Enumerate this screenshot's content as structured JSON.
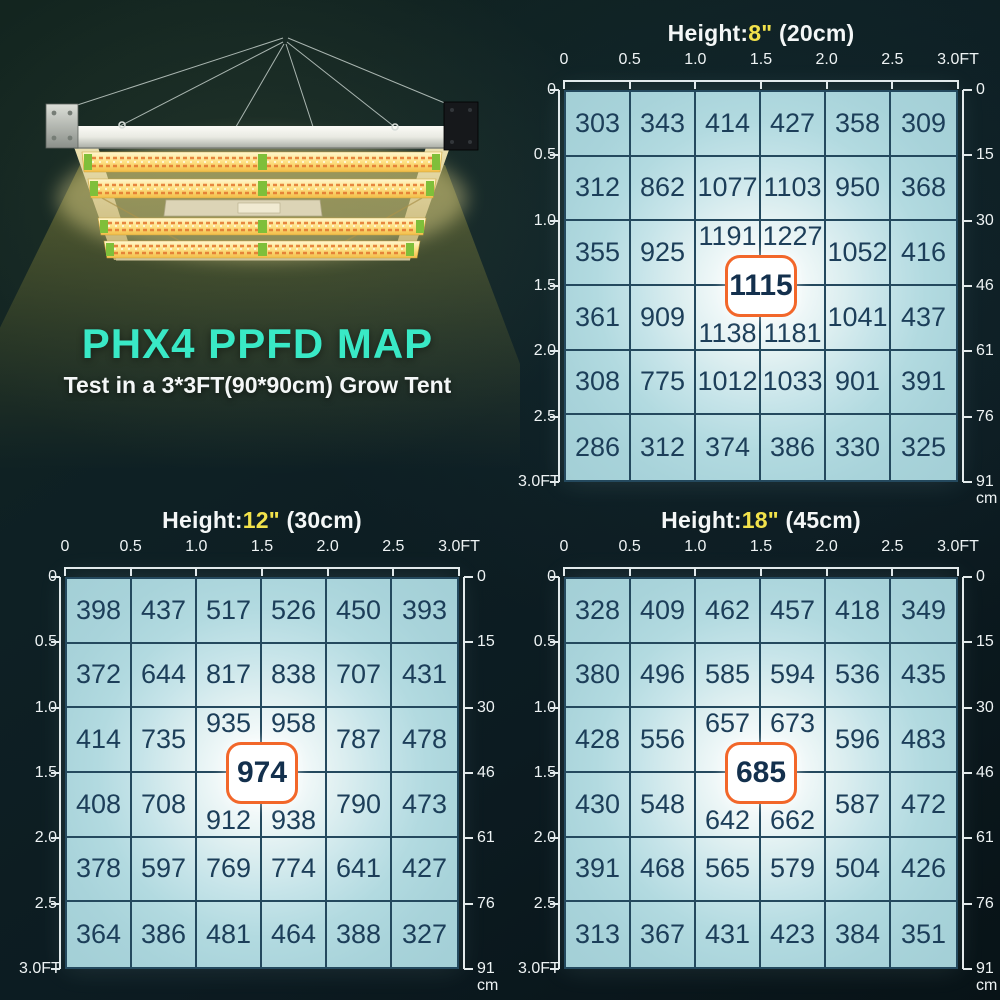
{
  "hero": {
    "title": "PHX4 PPFD MAP",
    "subtitle": "Test in a 3*3FT(90*90cm) Grow Tent"
  },
  "colors": {
    "accent_cyan": "#39e9c6",
    "height_yellow": "#f2e24b",
    "badge_orange": "#f2672a",
    "grid_line": "#24495e",
    "value_ink": "#1c3e59",
    "cell_bg": "#a8d3da",
    "axis_ink": "#eef3f4"
  },
  "chart_data": [
    {
      "type": "heatmap",
      "title": "Height:8\" (20cm)",
      "height_label": {
        "prefix": "Height:",
        "value": "8\"",
        "suffix": " (20cm)"
      },
      "x_ticks_ft": [
        "0",
        "0.5",
        "1.0",
        "1.5",
        "2.0",
        "2.5",
        "3.0FT"
      ],
      "y_ticks_ft": [
        "0",
        "0.5",
        "1.0",
        "1.5",
        "2.0",
        "2.5",
        "3.0FT"
      ],
      "y_ticks_cm": [
        "0",
        "15",
        "30",
        "46",
        "61",
        "76",
        "91"
      ],
      "cm_unit": "cm",
      "x_range_ft": [
        0,
        3.0
      ],
      "y_range_ft": [
        0,
        3.0
      ],
      "values": [
        [
          303,
          343,
          414,
          427,
          358,
          309
        ],
        [
          312,
          862,
          1077,
          1103,
          950,
          368
        ],
        [
          355,
          925,
          1191,
          1227,
          1052,
          416
        ],
        [
          361,
          909,
          1138,
          1181,
          1041,
          437
        ],
        [
          308,
          775,
          1012,
          1033,
          901,
          391
        ],
        [
          286,
          312,
          374,
          386,
          330,
          325
        ]
      ],
      "center_value": 1115
    },
    {
      "type": "heatmap",
      "title": "Height:12\" (30cm)",
      "height_label": {
        "prefix": "Height:",
        "value": "12\"",
        "suffix": " (30cm)"
      },
      "x_ticks_ft": [
        "0",
        "0.5",
        "1.0",
        "1.5",
        "2.0",
        "2.5",
        "3.0FT"
      ],
      "y_ticks_ft": [
        "0",
        "0.5",
        "1.0",
        "1.5",
        "2.0",
        "2.5",
        "3.0FT"
      ],
      "y_ticks_cm": [
        "0",
        "15",
        "30",
        "46",
        "61",
        "76",
        "91"
      ],
      "cm_unit": "cm",
      "x_range_ft": [
        0,
        3.0
      ],
      "y_range_ft": [
        0,
        3.0
      ],
      "values": [
        [
          398,
          437,
          517,
          526,
          450,
          393
        ],
        [
          372,
          644,
          817,
          838,
          707,
          431
        ],
        [
          414,
          735,
          935,
          958,
          787,
          478
        ],
        [
          408,
          708,
          912,
          938,
          790,
          473
        ],
        [
          378,
          597,
          769,
          774,
          641,
          427
        ],
        [
          364,
          386,
          481,
          464,
          388,
          327
        ]
      ],
      "center_value": 974
    },
    {
      "type": "heatmap",
      "title": "Height:18\" (45cm)",
      "height_label": {
        "prefix": "Height:",
        "value": "18\"",
        "suffix": " (45cm)"
      },
      "x_ticks_ft": [
        "0",
        "0.5",
        "1.0",
        "1.5",
        "2.0",
        "2.5",
        "3.0FT"
      ],
      "y_ticks_ft": [
        "0",
        "0.5",
        "1.0",
        "1.5",
        "2.0",
        "2.5",
        "3.0FT"
      ],
      "y_ticks_cm": [
        "0",
        "15",
        "30",
        "46",
        "61",
        "76",
        "91"
      ],
      "cm_unit": "cm",
      "x_range_ft": [
        0,
        3.0
      ],
      "y_range_ft": [
        0,
        3.0
      ],
      "values": [
        [
          328,
          409,
          462,
          457,
          418,
          349
        ],
        [
          380,
          496,
          585,
          594,
          536,
          435
        ],
        [
          428,
          556,
          657,
          673,
          596,
          483
        ],
        [
          430,
          548,
          642,
          662,
          587,
          472
        ],
        [
          391,
          468,
          565,
          579,
          504,
          426
        ],
        [
          313,
          367,
          431,
          423,
          384,
          351
        ]
      ],
      "center_value": 685
    }
  ]
}
